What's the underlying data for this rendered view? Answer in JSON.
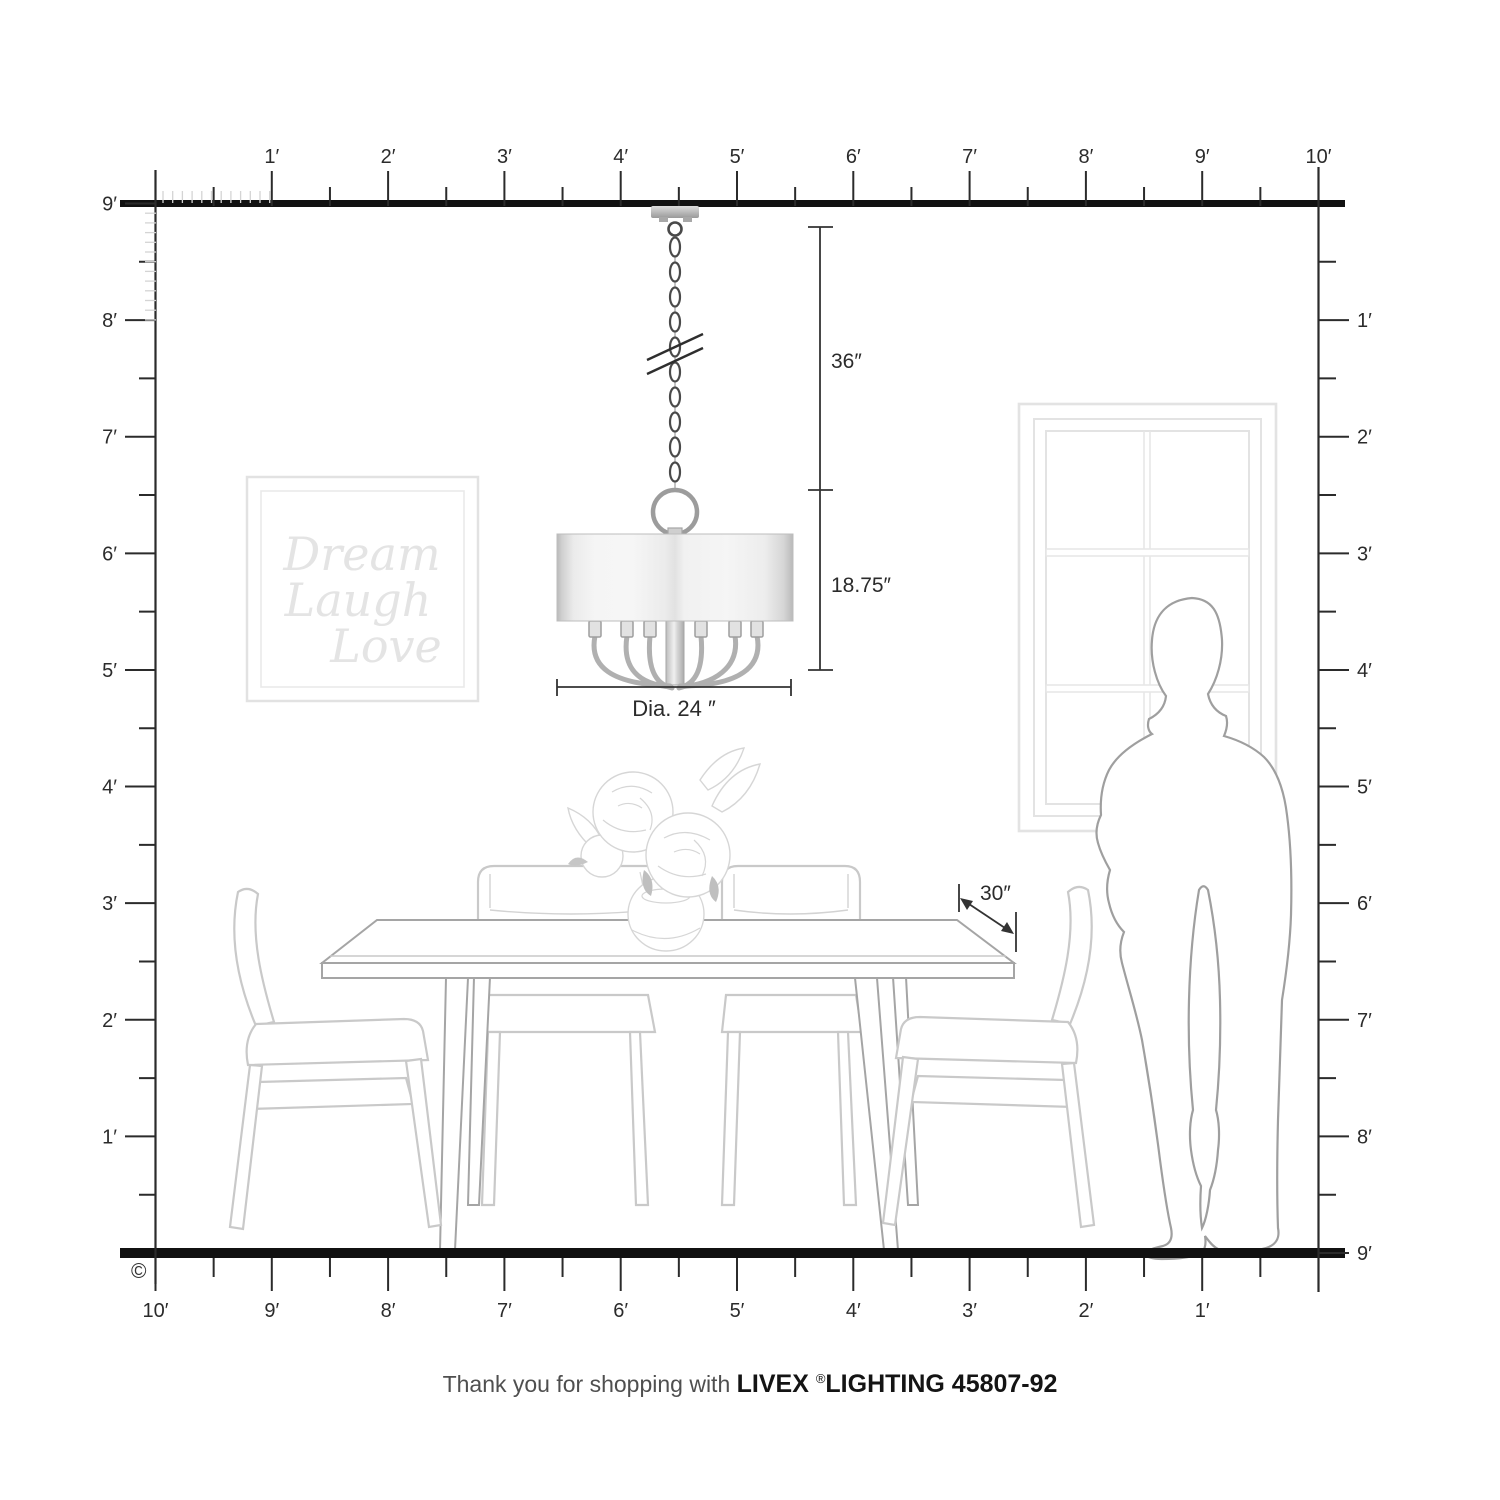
{
  "scene": {
    "copyright": "©"
  },
  "rulers": {
    "top": [
      "1′",
      "2′",
      "3′",
      "4′",
      "5′",
      "6′",
      "7′",
      "8′",
      "9′",
      "10′"
    ],
    "left": [
      "9′",
      "8′",
      "7′",
      "6′",
      "5′",
      "4′",
      "3′",
      "2′",
      "1′"
    ],
    "right": [
      "1′",
      "2′",
      "3′",
      "4′",
      "5′",
      "6′",
      "7′",
      "8′",
      "9′"
    ],
    "bottom": [
      "1′",
      "2′",
      "3′",
      "4′",
      "5′",
      "6′",
      "7′",
      "8′",
      "9′",
      "10′"
    ]
  },
  "annotations": {
    "hang_height": "36″",
    "fixture_height": "18.75″",
    "diameter": "Dia. 24 ″",
    "table_depth": "30″"
  },
  "wall_art": {
    "line1": "Dream",
    "line2": "Laugh",
    "line3": "Love"
  },
  "footer": {
    "prefix": "Thank you for shopping with ",
    "brand": "LIVEX ",
    "reg": "®",
    "suffix": "LIGHTING 45807-92"
  },
  "product": {
    "sku": "45807-92",
    "brand_name": "LIVEX LIGHTING"
  },
  "colors": {
    "ruler": "#2b2b2b",
    "frame_line": "#111111",
    "annotation": "#333333",
    "furniture": "#c9c9c9",
    "table": "#a5a5a5",
    "person": "#9f9f9f",
    "window": "#e3e3e3",
    "wall_art_text": "#e4e4e4",
    "metal_dark": "#4a4a4a",
    "metal_light": "#9c9c9c"
  }
}
